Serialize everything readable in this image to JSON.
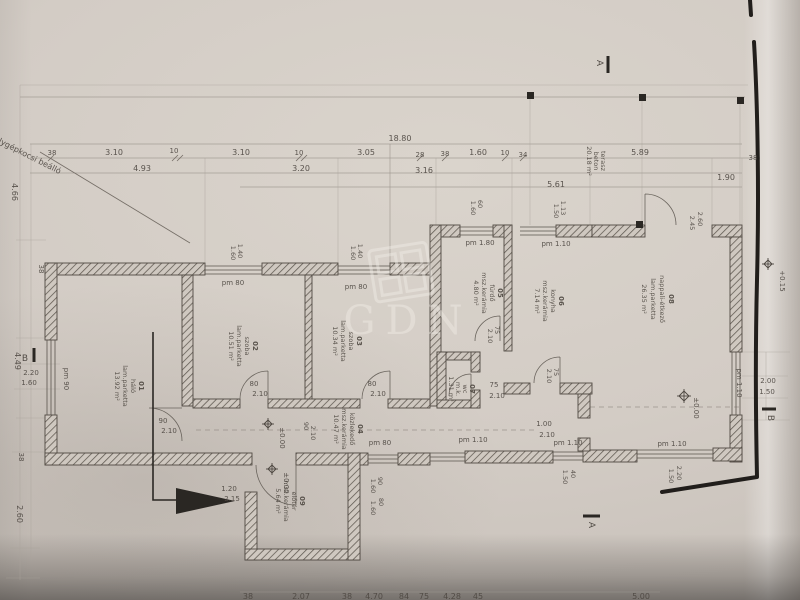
{
  "watermark": "GDN",
  "notes": {
    "parking": "1 db személygépkocsi beálló"
  },
  "rooms": [
    {
      "id": "01",
      "name": "háló",
      "floor": "lam.parketta",
      "area": "13.92 m²"
    },
    {
      "id": "02",
      "name": "szoba",
      "floor": "lam.parketta",
      "area": "10.51 m²"
    },
    {
      "id": "03",
      "name": "szoba",
      "floor": "lam.parketta",
      "area": "10.34 m²"
    },
    {
      "id": "04",
      "name": "közlekedő",
      "floor": "msz.kerámia",
      "area": "10.47 m²"
    },
    {
      "id": "05",
      "name": "fürdő",
      "floor": "msz.kerámia",
      "area": "4.80 m²"
    },
    {
      "id": "06",
      "name": "konyha",
      "floor": "msz.kerámia",
      "area": "7.14 m²"
    },
    {
      "id": "07",
      "name": "wc",
      "floor": "m.k.",
      "area": "1.31 m²"
    },
    {
      "id": "08",
      "name": "nappali-étkező",
      "floor": "lam.parketta",
      "area": "26.35 m²"
    },
    {
      "id": "09",
      "name": "előtér",
      "floor": "msz.kerámia",
      "area": "5.64 m²"
    }
  ],
  "terrace": {
    "name": "terasz",
    "floor": "beton",
    "area": "20.18 m²"
  },
  "labels": {
    "overall": "18.80",
    "v38": "38",
    "v310": "3.10",
    "v10": "10",
    "v305": "3.05",
    "v28": "28",
    "v160": "1.60",
    "v34": "34",
    "v589": "5.89",
    "v493": "4.93",
    "v320": "3.20",
    "v316": "3.16",
    "v561": "5.61",
    "v190": "1.90",
    "v466": "4.66",
    "v449": "4.49",
    "v220": "2.20",
    "v260": "2.60",
    "pm80": "pm 80",
    "pm90": "pm 90",
    "pm180": "pm 1.80",
    "pm110": "pm 1.10",
    "v90": "90",
    "v210": "2.10",
    "v80": "80",
    "v75": "75",
    "v100": "1.00",
    "v120": "1.20",
    "v215": "2.15",
    "v113": "1.13",
    "v150": "1.50",
    "v245": "2.45",
    "v140": "1.40",
    "v60": "60",
    "v40": "40",
    "v200": "2.00",
    "v207": "2.07",
    "v470": "4.70",
    "v84": "84",
    "v428": "4.28",
    "v45": "45",
    "v500": "5.00",
    "zero": "±0.00",
    "plus15": "+0.15",
    "secA": "A",
    "secB": "B"
  }
}
